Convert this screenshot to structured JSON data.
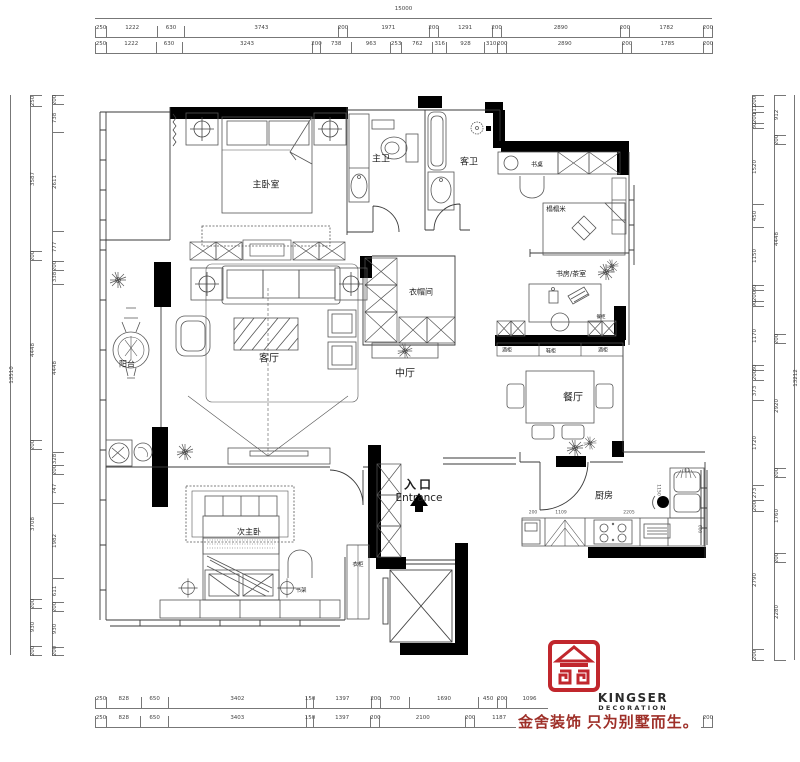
{
  "rooms": {
    "master_bedroom": "主卧室",
    "master_bath": "主卫",
    "guest_bath": "客卫",
    "desk": "书桌",
    "tatami": "榻榻米",
    "cloakroom": "衣帽间",
    "living": "客厅",
    "mid_hall": "中厅",
    "study_tea": "书房/茶室",
    "dining": "餐厅",
    "kitchen": "厨房",
    "balcony": "阳台",
    "second_master": "次主卧",
    "entrance_cn": "入口",
    "entrance_en": "Entrance"
  },
  "annotations": {
    "bookshelf": "书架",
    "wardrobe": "衣柜",
    "wine_cabinet_left": "酒柜",
    "shoe_cabinet": "鞋柜",
    "wine_cabinet_right": "酒柜",
    "side_cabinet": "餐柜"
  },
  "dimensions": {
    "top_overall": "15000",
    "top_row1": [
      250,
      1222,
      630,
      3743,
      200,
      1971,
      200,
      1291,
      200,
      2890,
      200,
      1782,
      200
    ],
    "top_row2": [
      250,
      1222,
      630,
      3243,
      200,
      738,
      963,
      253,
      762,
      316,
      928,
      310,
      200,
      2890,
      200,
      1785,
      200
    ],
    "bottom_row1": [
      250,
      828,
      650,
      3402,
      150,
      1397,
      200,
      700,
      1690,
      450,
      200,
      1096,
      247,
      200,
      3228,
      200
    ],
    "bottom_row2": [
      250,
      828,
      650,
      3403,
      150,
      1397,
      200,
      2100,
      200,
      1187,
      4435,
      200
    ],
    "left_overall": "13510",
    "left_outer": [
      250,
      3587,
      200,
      4448,
      200,
      3708,
      200,
      930,
      200
    ],
    "left_inner": [
      200,
      738,
      2611,
      777,
      200,
      338,
      4448,
      328,
      200,
      747,
      1982,
      611,
      200,
      930,
      200
    ],
    "right_overall": "13212",
    "right_outer": [
      912,
      200,
      4448,
      200,
      2920,
      200,
      1760,
      200,
      2280
    ],
    "right_inner": [
      200,
      111,
      200,
      80,
      1520,
      450,
      1150,
      80,
      200,
      90,
      1170,
      80,
      200,
      373,
      1720,
      273,
      200,
      2790,
      200
    ],
    "kitchen_seg_1": "200",
    "kitchen_seg_2": "1109",
    "kitchen_seg_3": "2205",
    "kitchen_depth": "1150",
    "kitchen_counter": "600"
  },
  "logo": {
    "brand": "KINGSER",
    "sub": "DECORATION",
    "tagline": "金舍装饰 只为别墅而生。",
    "red": "#c1272d",
    "dark_red": "#9e2f28"
  }
}
